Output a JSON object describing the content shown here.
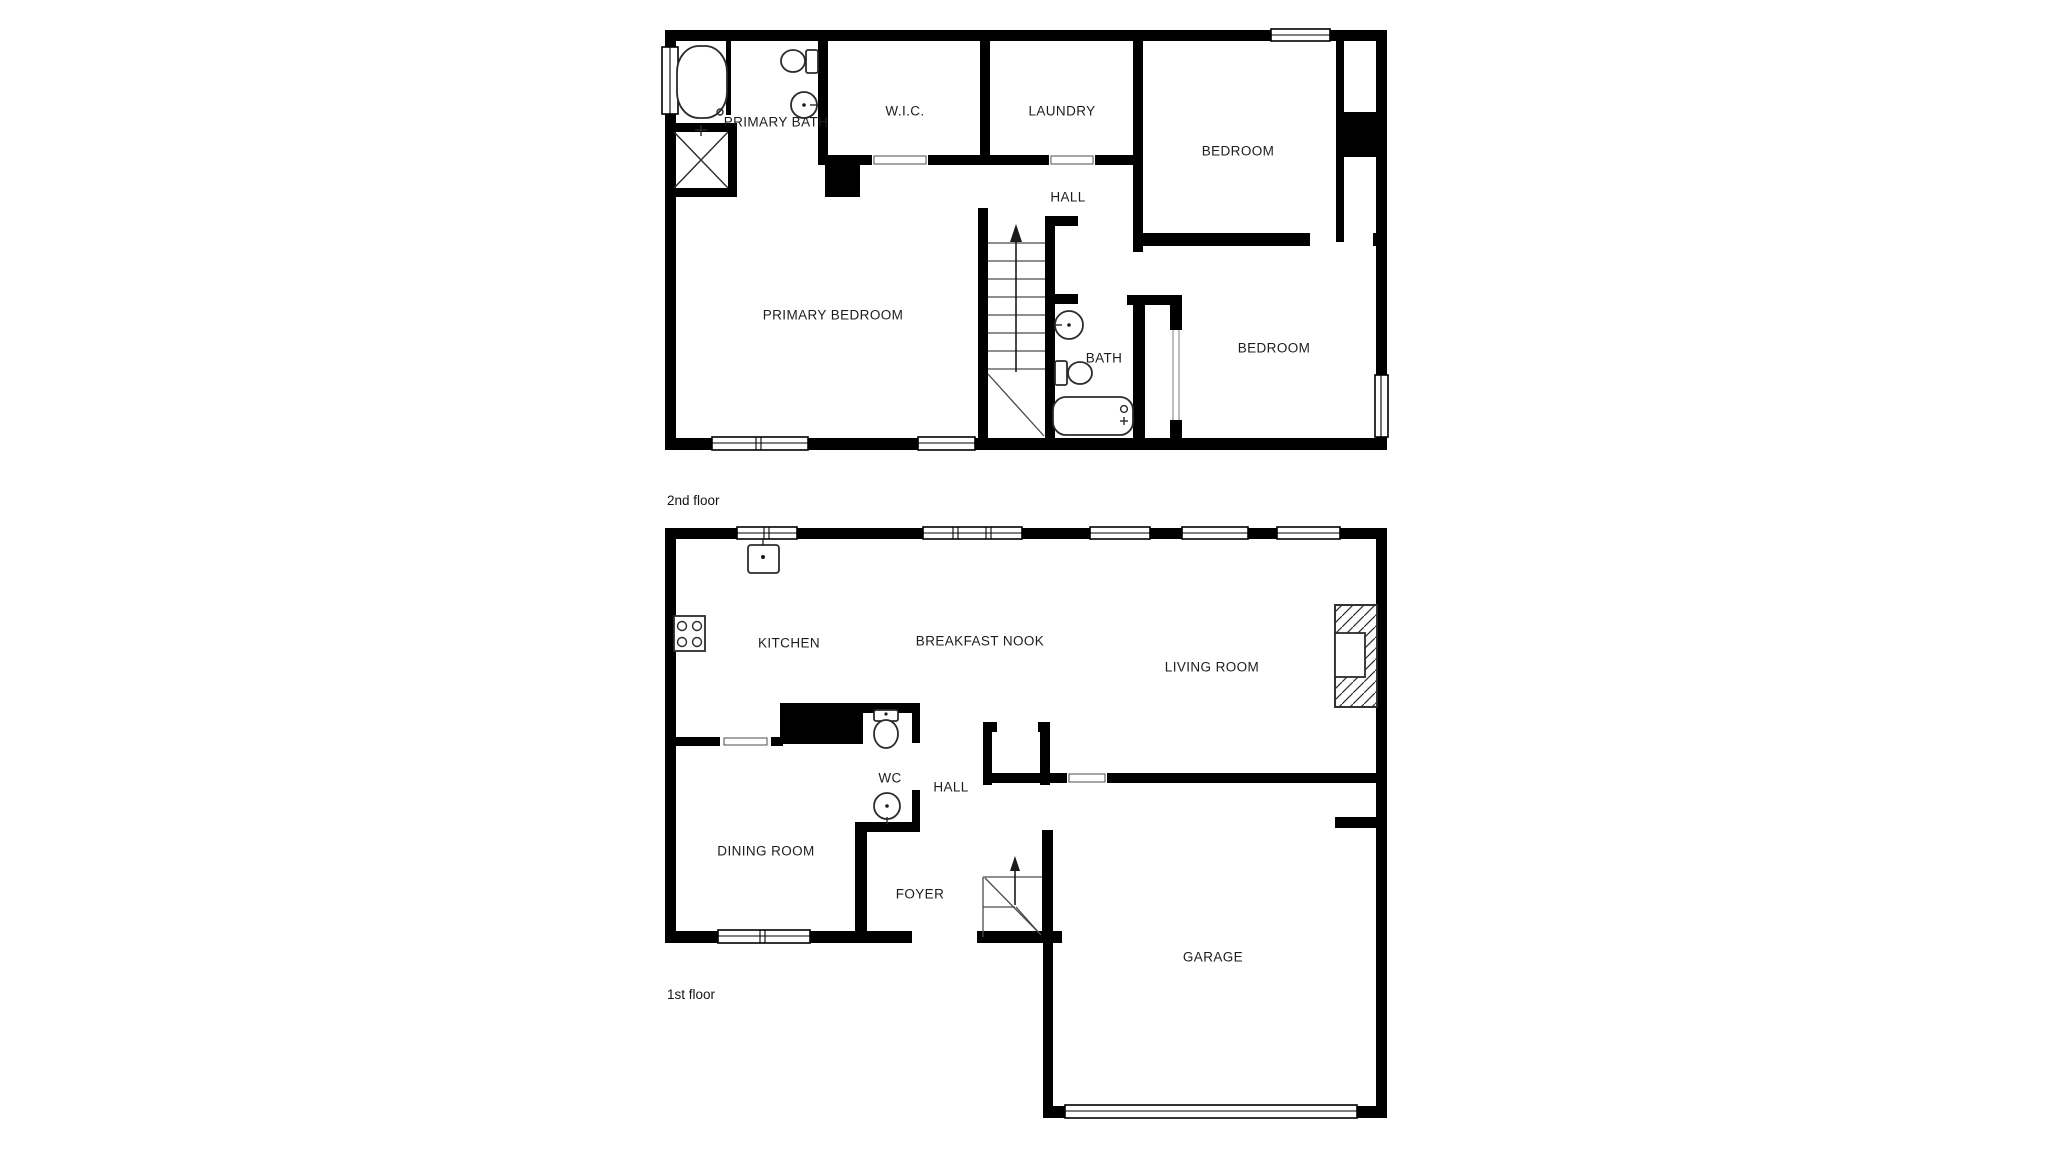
{
  "colors": {
    "background": "#ffffff",
    "walls": "#000000",
    "fixtures": "#2b2b2b",
    "text": "#1d1d1d"
  },
  "second_floor": {
    "floor_label": "2nd floor",
    "rooms": {
      "primary_bath": "PRIMARY BATH",
      "walk_in_closet": "W.I.C.",
      "laundry": "LAUNDRY",
      "bedroom_top": "BEDROOM",
      "hall": "HALL",
      "primary_bedroom": "PRIMARY BEDROOM",
      "bath": "BATH",
      "bedroom_right": "BEDROOM"
    },
    "fixtures": [
      "bathtub-icon",
      "toilet-icon",
      "sink-icon",
      "shower-icon",
      "stairs-up-icon",
      "bath-tub-icon",
      "closet-slider"
    ]
  },
  "first_floor": {
    "floor_label": "1st floor",
    "rooms": {
      "kitchen": "KITCHEN",
      "breakfast_nook": "BREAKFAST NOOK",
      "living_room": "LIVING ROOM",
      "wc": "WC",
      "hall": "HALL",
      "dining_room": "DINING ROOM",
      "foyer": "FOYER",
      "garage": "GARAGE"
    },
    "fixtures": [
      "kitchen-sink-icon",
      "stove-icon",
      "toilet-icon",
      "sink-icon",
      "fireplace-icon",
      "stairs-up-icon",
      "garage-door"
    ]
  }
}
